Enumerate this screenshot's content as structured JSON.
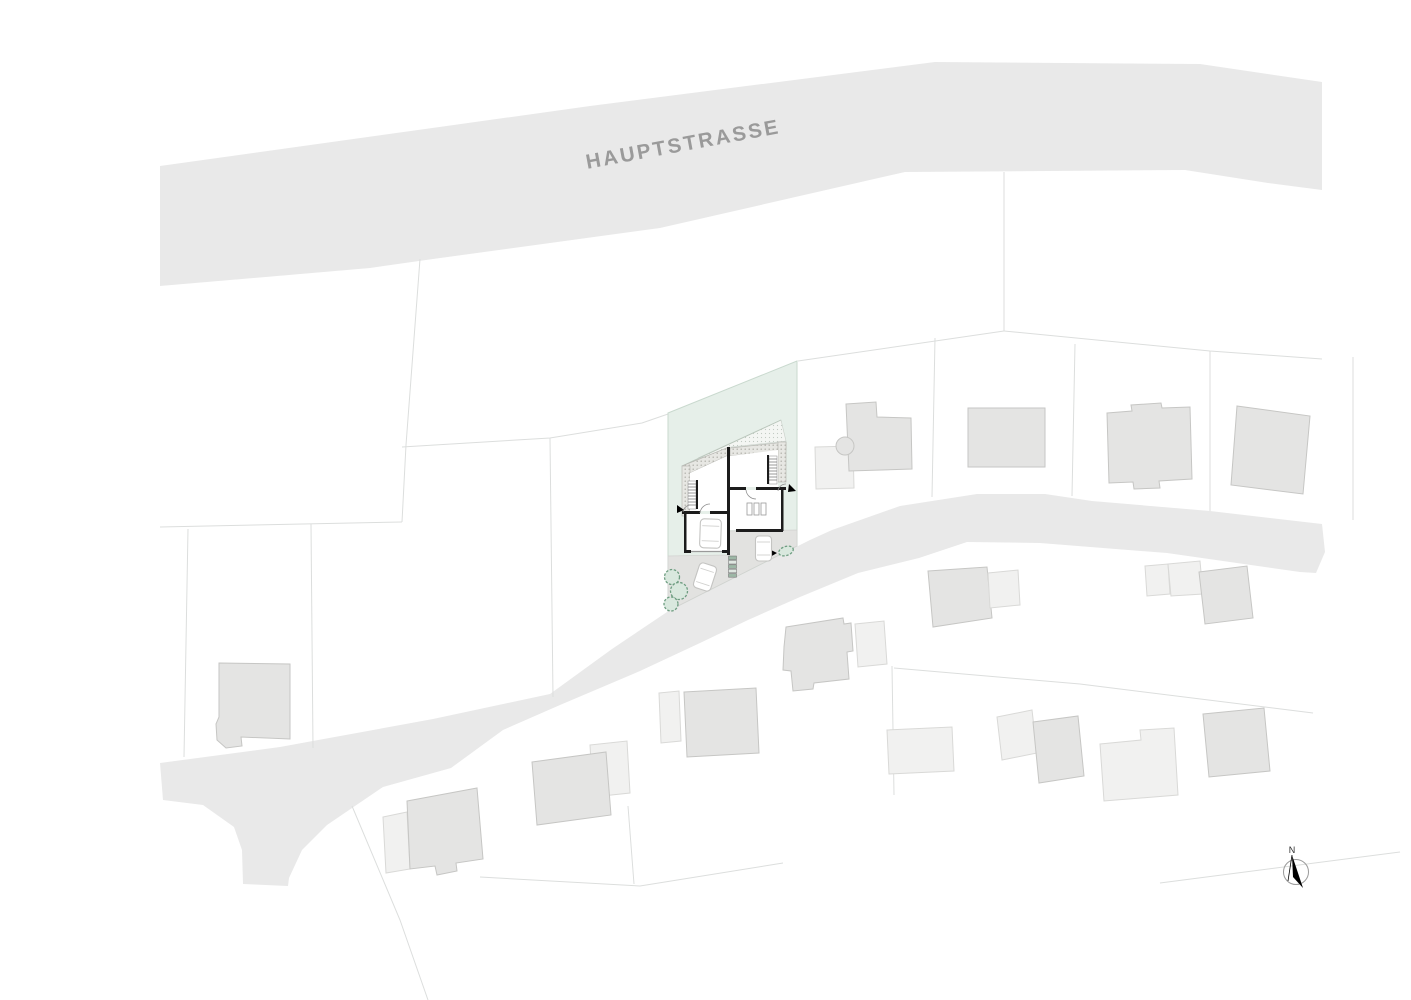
{
  "street": {
    "label": "HAUPTSTRASSE"
  },
  "compass": {
    "label": "N"
  },
  "palette": {
    "road_fill": "#e9e9e9",
    "street_label_color": "#9a9a9a",
    "parcel_line_color": "#dcdedd",
    "site_parcel_fill": "#e6efe9",
    "site_parcel_stroke": "#c9d9ce",
    "building_fill": "#e4e4e3",
    "building_stroke": "#c6c6c4",
    "building_light_fill": "#f1f1f0",
    "court_fill": "#e2e2e0",
    "wall_color": "#1c1c1c",
    "tree_stroke": "#6e9d81",
    "compass_color": "#000000"
  },
  "map": {
    "roads": [
      {
        "name": "road-hauptstrasse",
        "points": "160,166 590,106 935,62 1200,64 1322,82 1322,190 1268,183 1185,170 905,172 660,228 433,259 370,268 160,286"
      },
      {
        "name": "road-lower",
        "points": "160,763 280,747 433,719 550,694 612,649 670,610 810,540 832,530 900,506 977,494 1045,494 1092,501 1210,511 1322,524 1325,552 1316,573 1300,572 1167,553 1040,543 967,542 919,558 858,573 800,597 748,620 700,643 640,671 560,705 503,730 451,768 383,787 327,825 302,850 289,878 288,886 243,884 242,850 234,827 203,805 163,800"
      }
    ],
    "site_parcel": {
      "name": "site-parcel",
      "points": "668,413 797,361 797,546 668,611"
    },
    "court": {
      "name": "site-driveway-court",
      "points": "668,556 728,555 728,531 797,530 797,546 668,611"
    },
    "parcel_lines": [
      "420,259 406,445 402,522",
      "402,447 550,438 642,423 668,414",
      "160,527 402,522",
      "311,524 313,748",
      "188,529 184,757",
      "550,438 553,697",
      "798,361 1004,331",
      "1004,172 1004,331",
      "1004,331 1210,351 1322,359",
      "935,338 932,497",
      "1075,344 1072,496",
      "1210,351 1210,511",
      "1353,357 1353,520",
      "892,666 894,795",
      "894,668 1080,684",
      "1080,684 1313,713",
      "1160,883 1400,852",
      "352,806 400,920 428,1000",
      "480,877 640,886 783,863",
      "628,806 634,884"
    ],
    "buildings": [
      {
        "name": "building-annex",
        "shade": "light",
        "points": "815,447 853,446 854,488 816,489"
      },
      {
        "name": "building",
        "shade": "std",
        "points": "846,404 876,402 877,417 911,418 912,469 849,471"
      },
      {
        "name": "building-bay",
        "shade": "std",
        "circle": [
          845,
          446,
          9
        ]
      },
      {
        "name": "building",
        "shade": "std",
        "points": "968,408 1045,408 1045,467 968,467"
      },
      {
        "name": "building",
        "shade": "std",
        "points": "1107,413 1132,411 1131,405 1161,403 1162,408 1190,407 1192,479 1159,481 1160,488 1134,489 1133,482 1109,483"
      },
      {
        "name": "building",
        "shade": "std",
        "points": "1237,406 1310,416 1303,494 1231,485"
      },
      {
        "name": "building-annex",
        "shade": "light",
        "points": "855,624 884,621 887,664 858,667"
      },
      {
        "name": "building",
        "shade": "std",
        "points": "786,627 843,618 844,624 851,623 853,651 847,652 849,679 814,683 813,689 793,691 791,671 783,670 784,647"
      },
      {
        "name": "building",
        "shade": "std",
        "points": "928,571 987,567 992,618 933,627"
      },
      {
        "name": "building-annex",
        "shade": "light",
        "points": "988,573 1018,570 1020,605 990,608"
      },
      {
        "name": "building",
        "shade": "light",
        "points": "887,730 952,727 954,771 889,774"
      },
      {
        "name": "building-annex",
        "shade": "light",
        "points": "997,717 1032,710 1037,753 1002,760"
      },
      {
        "name": "building",
        "shade": "std",
        "points": "1033,722 1078,716 1084,776 1039,783"
      },
      {
        "name": "building-annex",
        "shade": "light",
        "points": "1145,566 1168,564 1170,594 1147,596"
      },
      {
        "name": "building-annex",
        "shade": "light",
        "points": "1168,564 1200,561 1203,594 1171,596"
      },
      {
        "name": "building",
        "shade": "std",
        "points": "1199,572 1247,566 1253,618 1205,624"
      },
      {
        "name": "building",
        "shade": "light",
        "points": "1100,744 1141,740 1140,730 1174,728 1178,795 1104,801"
      },
      {
        "name": "building",
        "shade": "std",
        "points": "1203,714 1264,708 1270,771 1209,777"
      },
      {
        "name": "building",
        "shade": "std",
        "points": "219,663 290,664 290,739 241,737 242,746 226,748 217,740 216,724 219,717"
      },
      {
        "name": "building-annex",
        "shade": "light",
        "points": "383,817 407,812 410,869 386,873"
      },
      {
        "name": "building",
        "shade": "std",
        "points": "407,801 477,788 483,859 456,863 457,871 437,875 435,866 410,869"
      },
      {
        "name": "building-annex",
        "shade": "light",
        "points": "590,745 627,741 630,793 593,797"
      },
      {
        "name": "building",
        "shade": "std",
        "points": "532,762 606,752 611,815 537,825"
      },
      {
        "name": "building-annex",
        "shade": "light",
        "points": "659,693 679,691 681,741 661,743"
      },
      {
        "name": "building",
        "shade": "std",
        "points": "684,692 756,688 759,753 687,757"
      }
    ]
  }
}
